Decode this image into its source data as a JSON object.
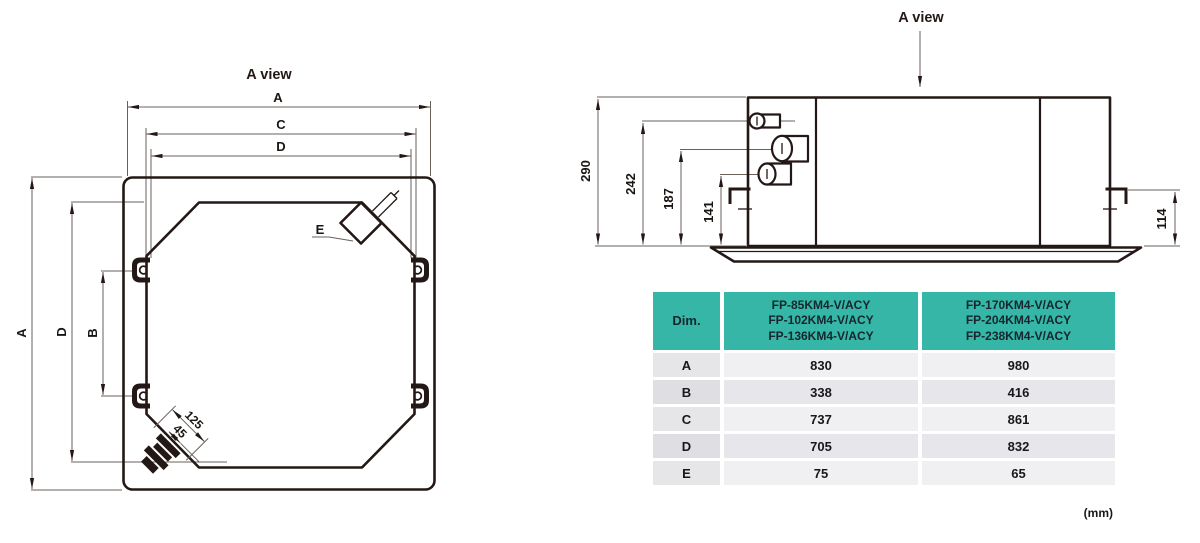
{
  "figure": {
    "type": "technical-dimension-drawing",
    "subject": "ceiling cassette indoor unit dimensions"
  },
  "top_view": {
    "title": "A view",
    "labels": {
      "a": "A",
      "c": "C",
      "d": "D",
      "b": "B",
      "e": "E",
      "pipe_len": "125",
      "pipe_offset": "45"
    }
  },
  "side_view": {
    "title": "A view",
    "labels": {
      "h_total": "290",
      "h_242": "242",
      "h_187": "187",
      "h_141": "141",
      "h_right": "114"
    }
  },
  "table": {
    "dim_header": "Dim.",
    "col1_models": [
      "FP-85KM4-V/ACY",
      "FP-102KM4-V/ACY",
      "FP-136KM4-V/ACY"
    ],
    "col2_models": [
      "FP-170KM4-V/ACY",
      "FP-204KM4-V/ACY",
      "FP-238KM4-V/ACY"
    ],
    "rows": [
      {
        "dim": "A",
        "v1": "830",
        "v2": "980"
      },
      {
        "dim": "B",
        "v1": "338",
        "v2": "416"
      },
      {
        "dim": "C",
        "v1": "737",
        "v2": "861"
      },
      {
        "dim": "D",
        "v1": "705",
        "v2": "832"
      },
      {
        "dim": "E",
        "v1": "75",
        "v2": "65"
      }
    ],
    "unit": "(mm)"
  },
  "colors": {
    "header_bg": "#35b6a6",
    "header_text": "#15262e",
    "row_label_bg": "#e6e6e9",
    "row_value_bg": "#f0f0f2",
    "line_color": "#231815",
    "dim_line_color": "#6a615b"
  }
}
